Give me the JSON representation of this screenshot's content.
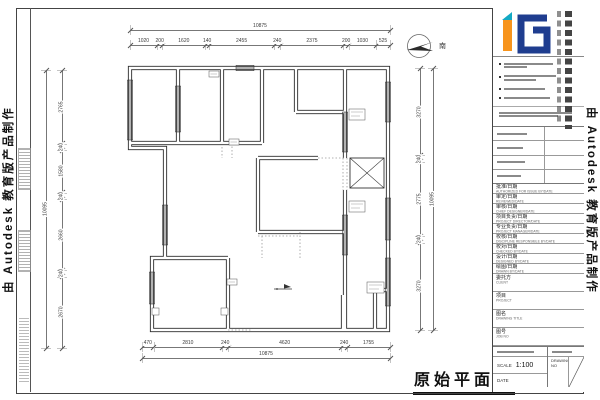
{
  "watermarks": {
    "left": "由 Autodesk 教育版产品制作",
    "right": "由 Autodesk 教育版产品制作"
  },
  "drawing": {
    "title": "原始平面图",
    "compass_label": "南"
  },
  "dimensions": {
    "top": {
      "overall": "10875",
      "segments": [
        "1020",
        "200",
        "1620",
        "140",
        "2455",
        "240",
        "2375",
        "200",
        "1030",
        "525"
      ]
    },
    "bottom": {
      "overall": "10875",
      "segments": [
        "470",
        "2810",
        "240",
        "4620",
        "240",
        "1755"
      ]
    },
    "left": {
      "overall": "10095",
      "segments": [
        "2765",
        "240",
        "1580",
        "240",
        "2660",
        "240",
        "2670"
      ]
    },
    "right": {
      "overall": "10095",
      "segments": [
        "3270",
        "240",
        "2775",
        "240",
        "3270"
      ]
    }
  },
  "titleblock": {
    "rows": [
      {
        "cn": "批准/日期",
        "en": "AUTHORIZED FOR ISSUE BY/DATE"
      },
      {
        "cn": "审定/日期",
        "en": "REVIEWED/DATE"
      },
      {
        "cn": "审核/日期",
        "en": "CHIEF DESIGNER/DATE"
      },
      {
        "cn": "项目负责/日期",
        "en": "PROJECT DIRECTOR/DATE"
      },
      {
        "cn": "专业负责/日期",
        "en": "PROJECT MANAGER/DATE"
      },
      {
        "cn": "校核/日期",
        "en": "DISCIPLINE RESPONSIBLE BY/DATE"
      },
      {
        "cn": "校对/日期",
        "en": "CHECKED BY/DATE"
      },
      {
        "cn": "设计/日期",
        "en": "DESIGNED BY/DATE"
      },
      {
        "cn": "绘图/日期",
        "en": "DRAWN BY/DATE"
      },
      {
        "cn": "委托方",
        "en": "CLIENT"
      },
      {
        "cn": "项目",
        "en": "PROJECT"
      },
      {
        "cn": "图名",
        "en": "DRAWING TITLE"
      },
      {
        "cn": "图号",
        "en": "JOB NO"
      }
    ],
    "scale": {
      "label": "SCALE",
      "value": "1:100"
    },
    "date_label": "DATE",
    "drawing_no_label": "DRAWING NO"
  }
}
